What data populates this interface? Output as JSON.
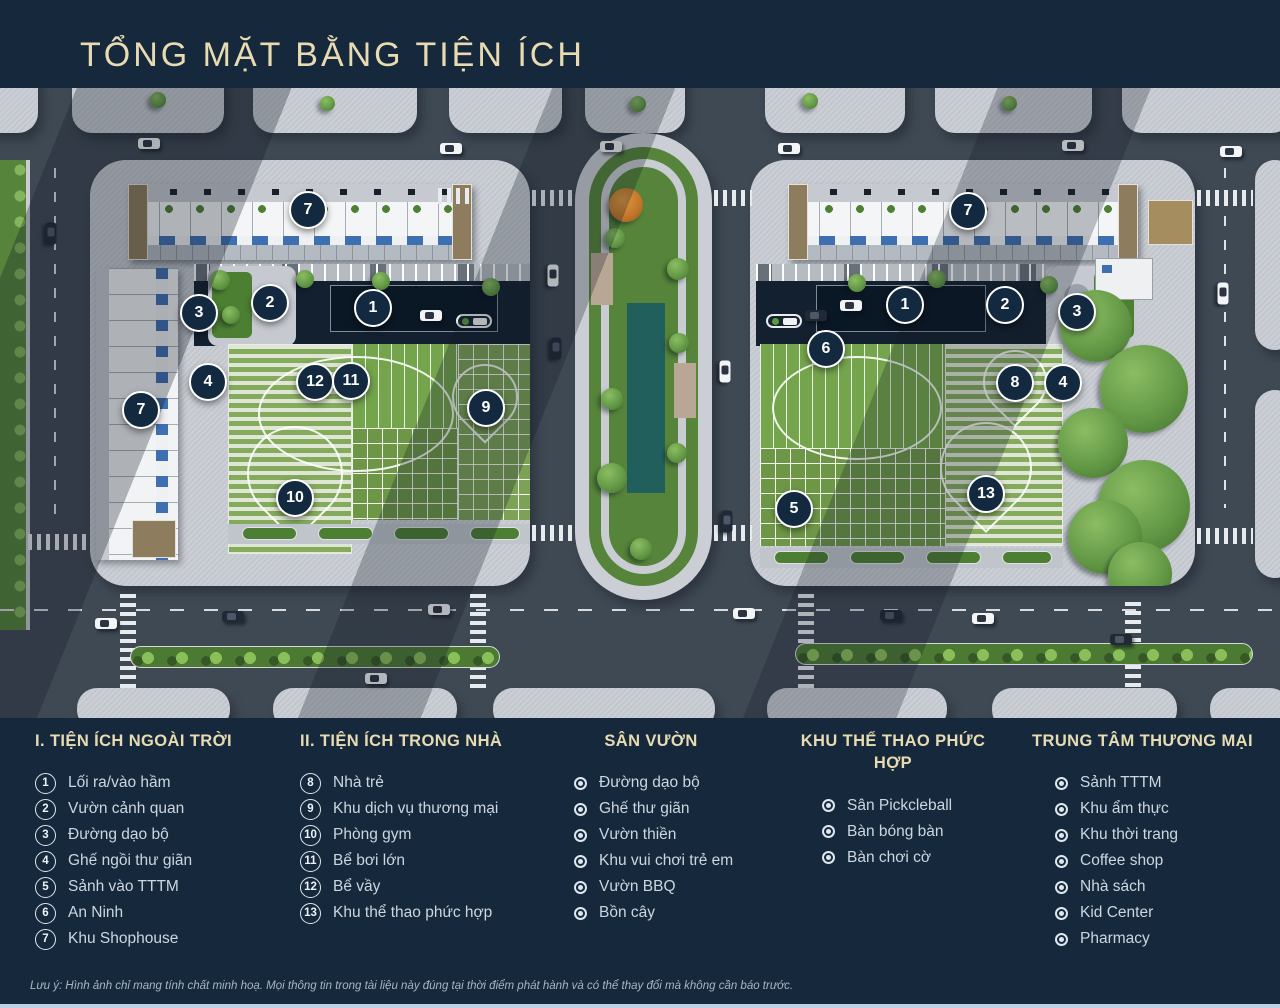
{
  "title": "TỔNG MẶT BẰNG TIỆN ÍCH",
  "disclaimer": "Lưu ý: Hình ảnh chỉ mang tính chất minh hoạ. Mọi thông tin trong tài liệu này đúng tại thời điểm phát hành và có thể thay đổi mà không cần báo trước.",
  "colors": {
    "background": "#16293c",
    "gold": "#e8dbb2",
    "text": "#ccd6e0",
    "marker_fill": "#13293f",
    "marker_border": "#ffffff",
    "road": "#3f4954",
    "block": "#c9cdd3",
    "lawn": "#74a44c",
    "pond": "#215f5d"
  },
  "legend": {
    "sections": [
      {
        "id": "outdoor",
        "header": "I. TIỆN ÍCH NGOÀI TRỜI",
        "style": "numbered",
        "items": [
          {
            "num": "1",
            "label": "Lối ra/vào hầm"
          },
          {
            "num": "2",
            "label": "Vườn cảnh quan"
          },
          {
            "num": "3",
            "label": "Đường dạo bộ"
          },
          {
            "num": "4",
            "label": "Ghế ngồi thư giãn"
          },
          {
            "num": "5",
            "label": "Sảnh vào TTTM"
          },
          {
            "num": "6",
            "label": "An Ninh"
          },
          {
            "num": "7",
            "label": "Khu Shophouse"
          }
        ]
      },
      {
        "id": "indoor",
        "header": "II. TIỆN ÍCH TRONG NHÀ",
        "style": "numbered",
        "items": [
          {
            "num": "8",
            "label": "Nhà trẻ"
          },
          {
            "num": "9",
            "label": "Khu dịch vụ thương mại"
          },
          {
            "num": "10",
            "label": "Phòng gym"
          },
          {
            "num": "11",
            "label": "Bể bơi lớn"
          },
          {
            "num": "12",
            "label": "Bể vầy"
          },
          {
            "num": "13",
            "label": "Khu thể thao phức hợp"
          }
        ]
      },
      {
        "id": "garden",
        "header": "SÂN VƯỜN",
        "style": "bullet",
        "items": [
          {
            "label": "Đường dạo bộ"
          },
          {
            "label": "Ghế thư giãn"
          },
          {
            "label": "Vườn thiền"
          },
          {
            "label": "Khu vui chơi trẻ em"
          },
          {
            "label": "Vườn BBQ"
          },
          {
            "label": "Bồn cây"
          }
        ]
      },
      {
        "id": "sports",
        "header": "KHU THỂ THAO PHỨC HỢP",
        "style": "bullet",
        "items": [
          {
            "label": "Sân Pickcleball"
          },
          {
            "label": "Bàn bóng bàn"
          },
          {
            "label": "Bàn chơi cờ"
          }
        ]
      },
      {
        "id": "mall",
        "header": "TRUNG TÂM THƯƠNG MẠI",
        "style": "bullet",
        "items": [
          {
            "label": "Sảnh TTTM"
          },
          {
            "label": "Khu ẩm thực"
          },
          {
            "label": "Khu thời trang"
          },
          {
            "label": "Coffee shop"
          },
          {
            "label": "Nhà sách"
          },
          {
            "label": "Kid Center"
          },
          {
            "label": "Pharmacy"
          }
        ]
      }
    ]
  },
  "map": {
    "markers": [
      {
        "n": "7",
        "x": 308,
        "y": 122
      },
      {
        "n": "3",
        "x": 199,
        "y": 225
      },
      {
        "n": "2",
        "x": 270,
        "y": 215
      },
      {
        "n": "1",
        "x": 373,
        "y": 220
      },
      {
        "n": "4",
        "x": 208,
        "y": 294
      },
      {
        "n": "7",
        "x": 141,
        "y": 322
      },
      {
        "n": "12",
        "x": 315,
        "y": 294
      },
      {
        "n": "11",
        "x": 351,
        "y": 293
      },
      {
        "n": "9",
        "x": 486,
        "y": 320
      },
      {
        "n": "10",
        "x": 295,
        "y": 410
      },
      {
        "n": "7",
        "x": 968,
        "y": 123
      },
      {
        "n": "1",
        "x": 905,
        "y": 217
      },
      {
        "n": "2",
        "x": 1005,
        "y": 217
      },
      {
        "n": "3",
        "x": 1077,
        "y": 224
      },
      {
        "n": "6",
        "x": 826,
        "y": 261
      },
      {
        "n": "8",
        "x": 1015,
        "y": 295
      },
      {
        "n": "4",
        "x": 1063,
        "y": 295
      },
      {
        "n": "5",
        "x": 794,
        "y": 421
      },
      {
        "n": "13",
        "x": 986,
        "y": 406
      }
    ]
  }
}
